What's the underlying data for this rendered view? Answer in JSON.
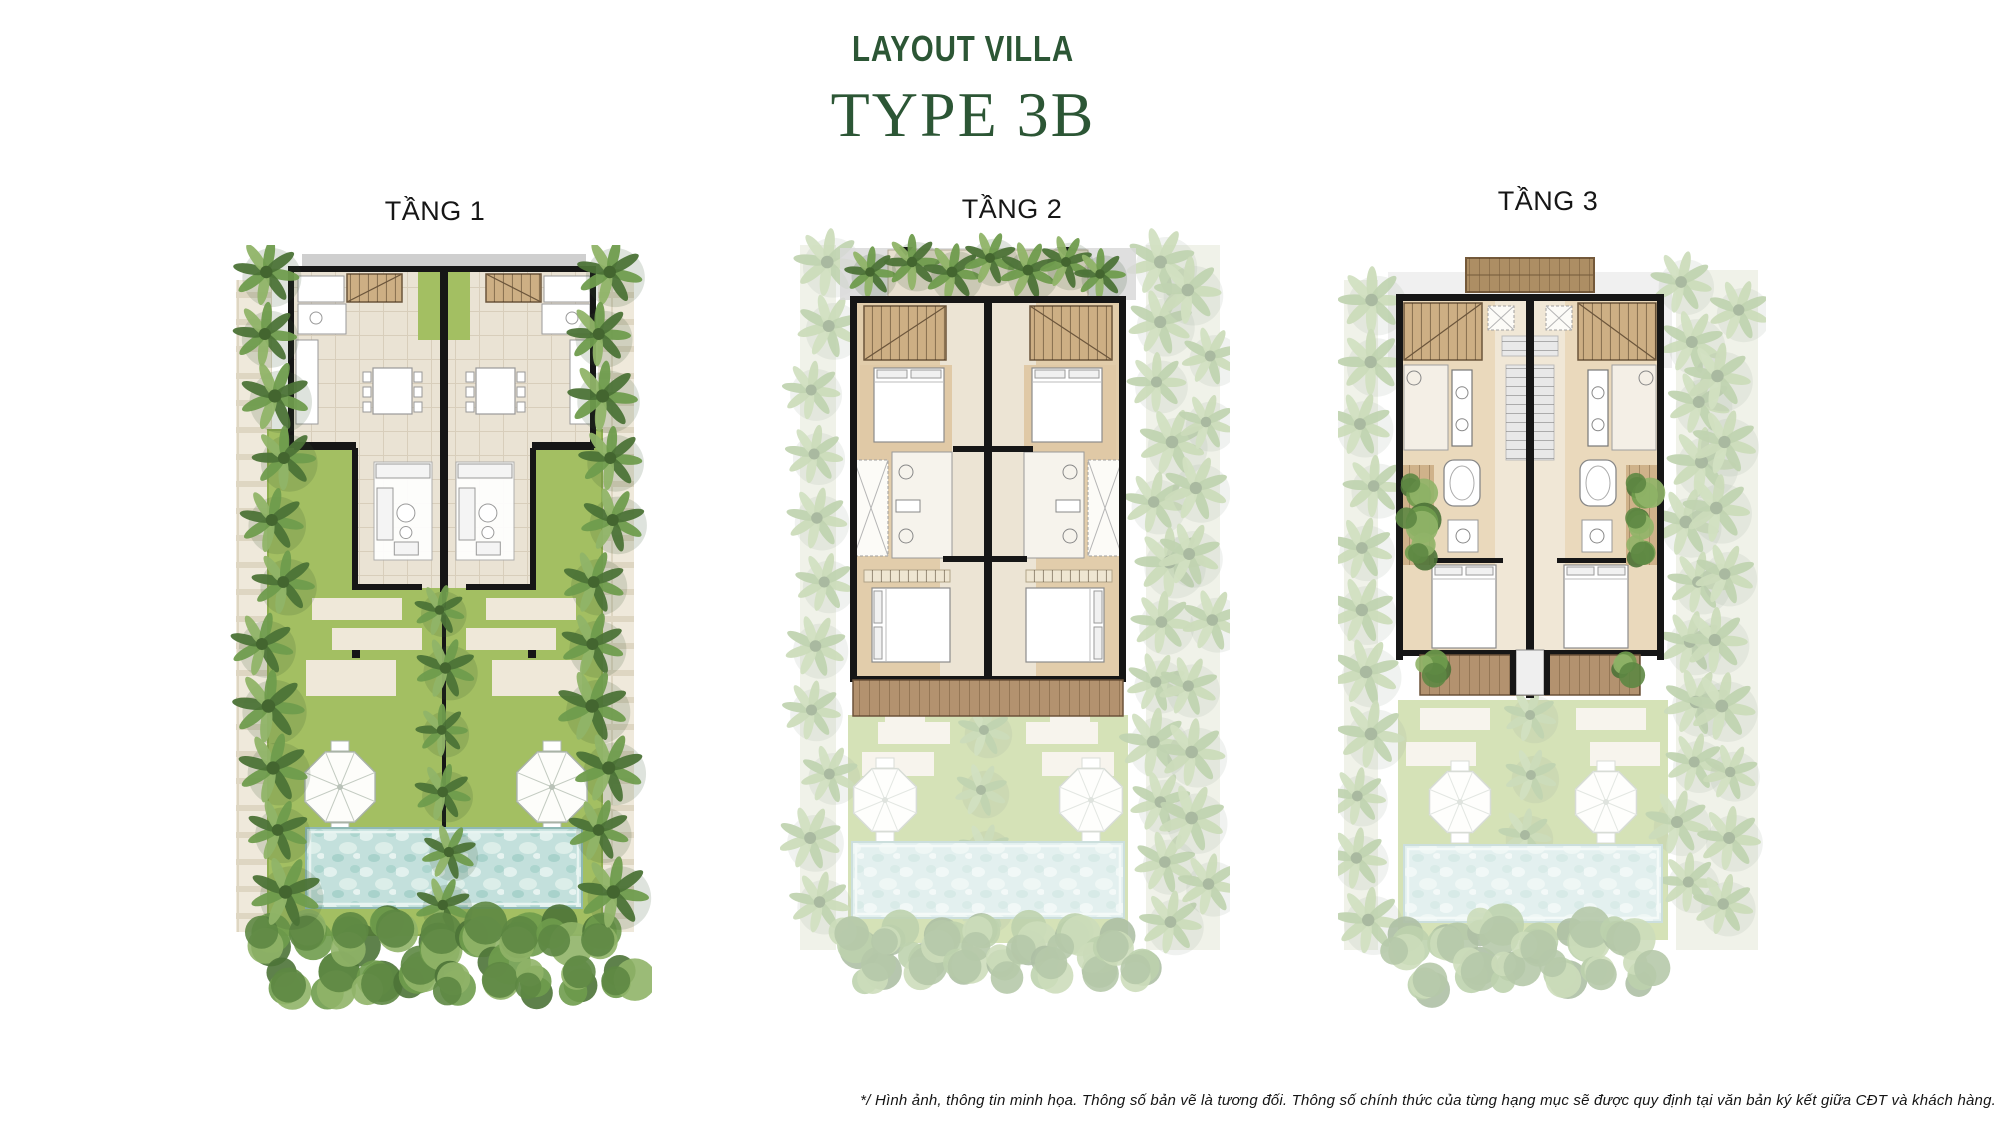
{
  "header": {
    "title": "LAYOUT VILLA",
    "subtitle": "TYPE 3B"
  },
  "plans": [
    {
      "id": "tang-1",
      "label": "TẦNG 1"
    },
    {
      "id": "tang-2",
      "label": "TẦNG 2"
    },
    {
      "id": "tang-3",
      "label": "TẦNG 3"
    }
  ],
  "footer": {
    "disclaimer": "*/ Hình ảnh, thông tin minh họa. Thông số bản vẽ là tương đối. Thông số chính thức của từng hạng mục sẽ được quy định tại văn bản ký kết giữa CĐT và khách hàng."
  },
  "palette": {
    "accent_green": "#2c5635",
    "label_color": "#161616",
    "lawn": "#a3bf62",
    "lawn_dark": "#8fae50",
    "path_beige": "#ded6c2",
    "slab_beige": "#efe8d9",
    "floor_tile": "#eae3d4",
    "floor_wood": "#e2cdab",
    "deck_wood": "#b3926f",
    "stair_wood": "#cdaf84",
    "roof_gray": "#cfcfcf",
    "roof_brown": "#ad8e64",
    "pool_blue": "#c3e0dc",
    "wall_black": "#161616",
    "tree_green_dark": "#4c7337",
    "tree_green_mid": "#6f9c4d",
    "tree_green_light": "#90b468"
  }
}
